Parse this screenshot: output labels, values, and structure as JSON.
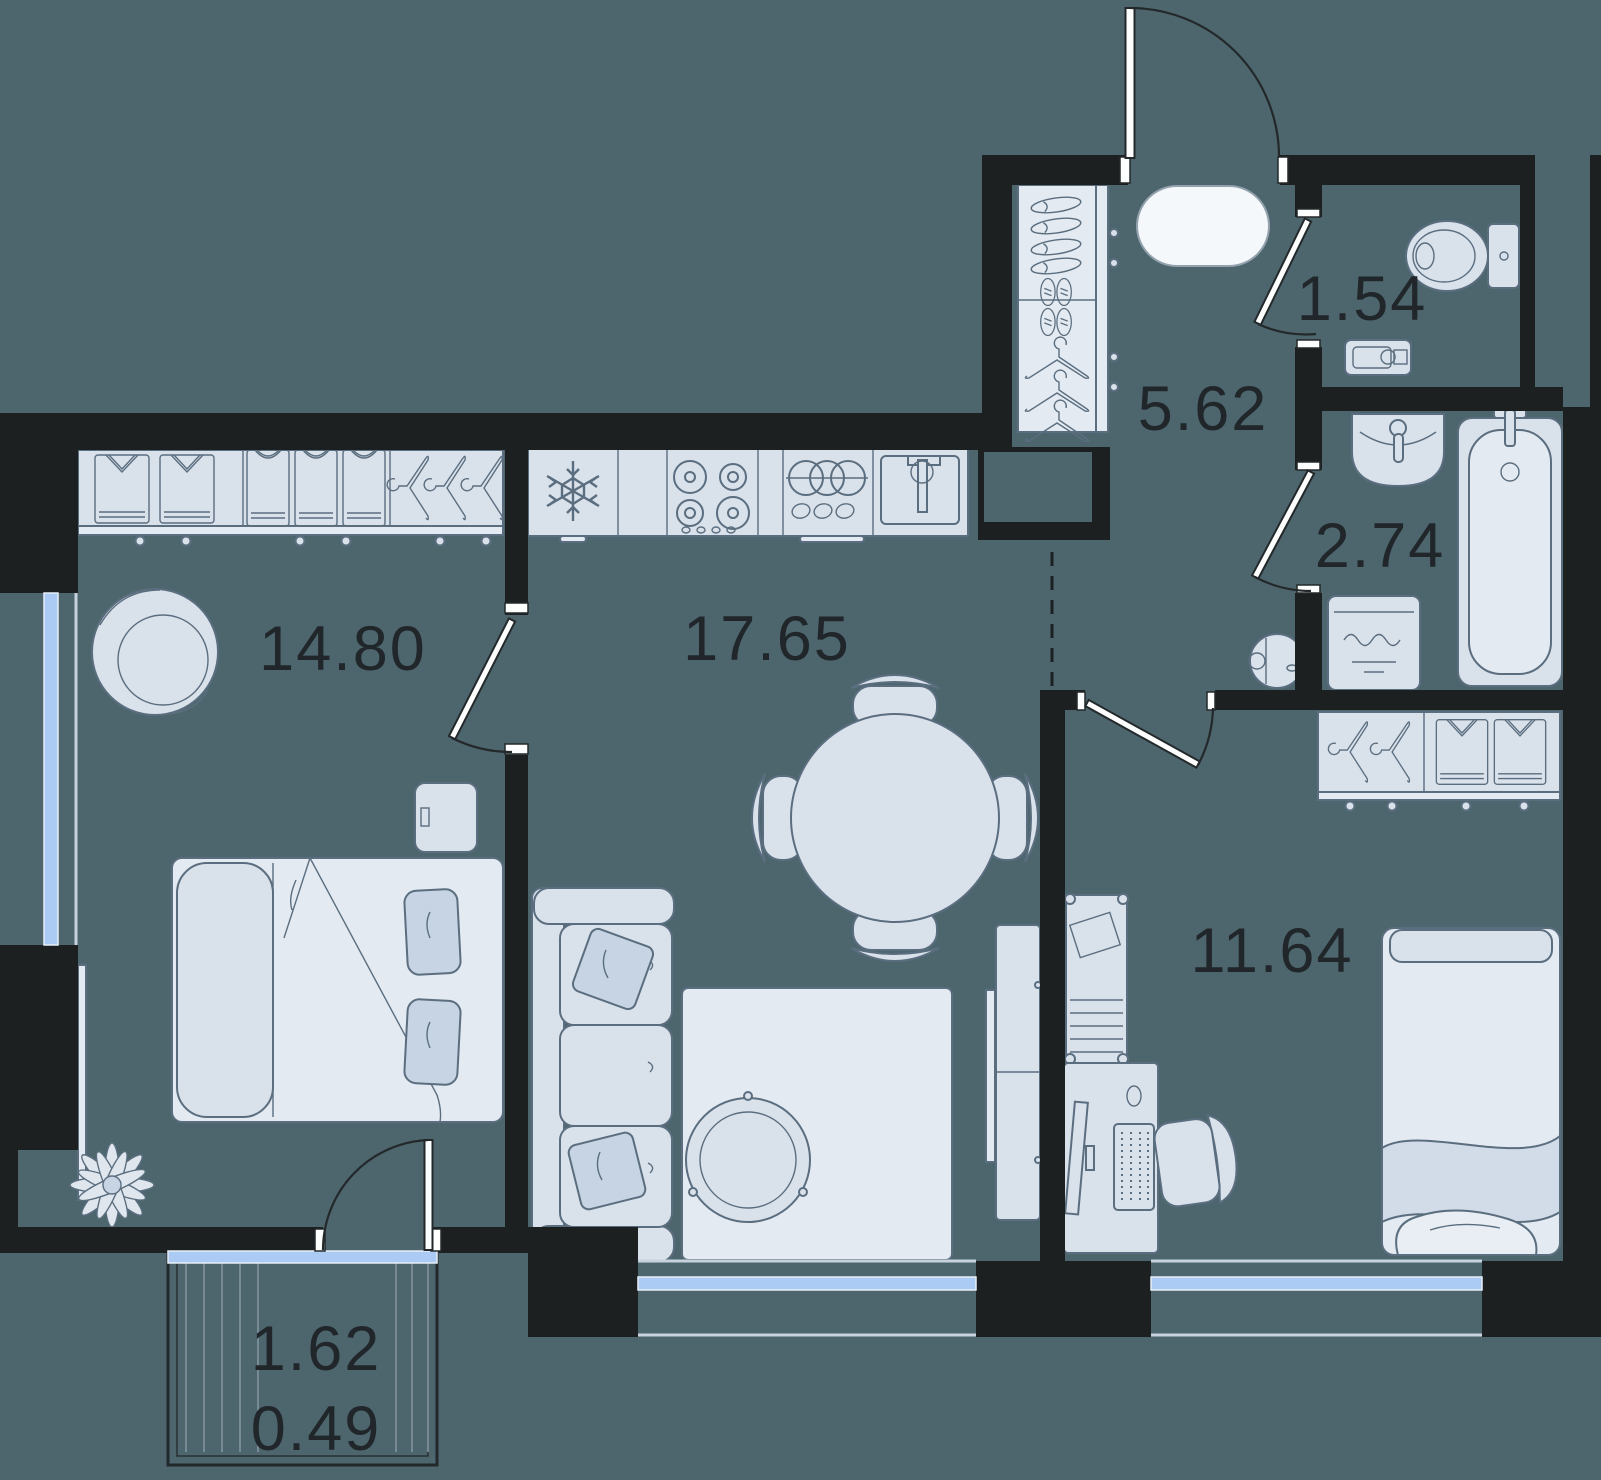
{
  "plan": {
    "title": "Apartment floor plan",
    "rooms": [
      {
        "name": "bedroom",
        "area": "14.80"
      },
      {
        "name": "kitchen-living-room",
        "area": "17.65"
      },
      {
        "name": "hallway",
        "area": "5.62"
      },
      {
        "name": "wc",
        "area": "1.54"
      },
      {
        "name": "bathroom",
        "area": "2.74"
      },
      {
        "name": "bedroom-2",
        "area": "11.64"
      },
      {
        "name": "balcony",
        "area": "1.62",
        "area_reduced": "0.49"
      }
    ],
    "colors": {
      "background": "#4d666e",
      "walls": "#1d2021",
      "furniture_fill": "#d9e1eb",
      "furniture_light": "#e3eaf2",
      "pillow": "#c6d4e3",
      "outline": "#5b6e7f",
      "window_glass": "#accbf4",
      "label_text": "#20262a",
      "rug_white": "#f5f8fa"
    },
    "icons": [
      "wardrobe-icon",
      "armchair-icon",
      "double-bed-icon",
      "tv-icon",
      "plant-icon",
      "fridge-snowflake-icon",
      "stove-icon",
      "dish-rack-icon",
      "kitchen-sink-icon",
      "dining-table-icon",
      "chair-icon",
      "sofa-icon",
      "coffee-table-icon",
      "rug-icon",
      "tv-stand-icon",
      "shoe-rack-icon",
      "hanger-icon",
      "oval-rug-icon",
      "entrance-door-icon",
      "toilet-icon",
      "shelf-icon",
      "wash-basin-icon",
      "bathtub-icon",
      "washing-machine-icon",
      "robot-vacuum-icon",
      "desk-icon",
      "monitor-icon",
      "keyboard-icon",
      "office-chair-icon",
      "bookshelf-icon",
      "single-bed-icon"
    ]
  }
}
